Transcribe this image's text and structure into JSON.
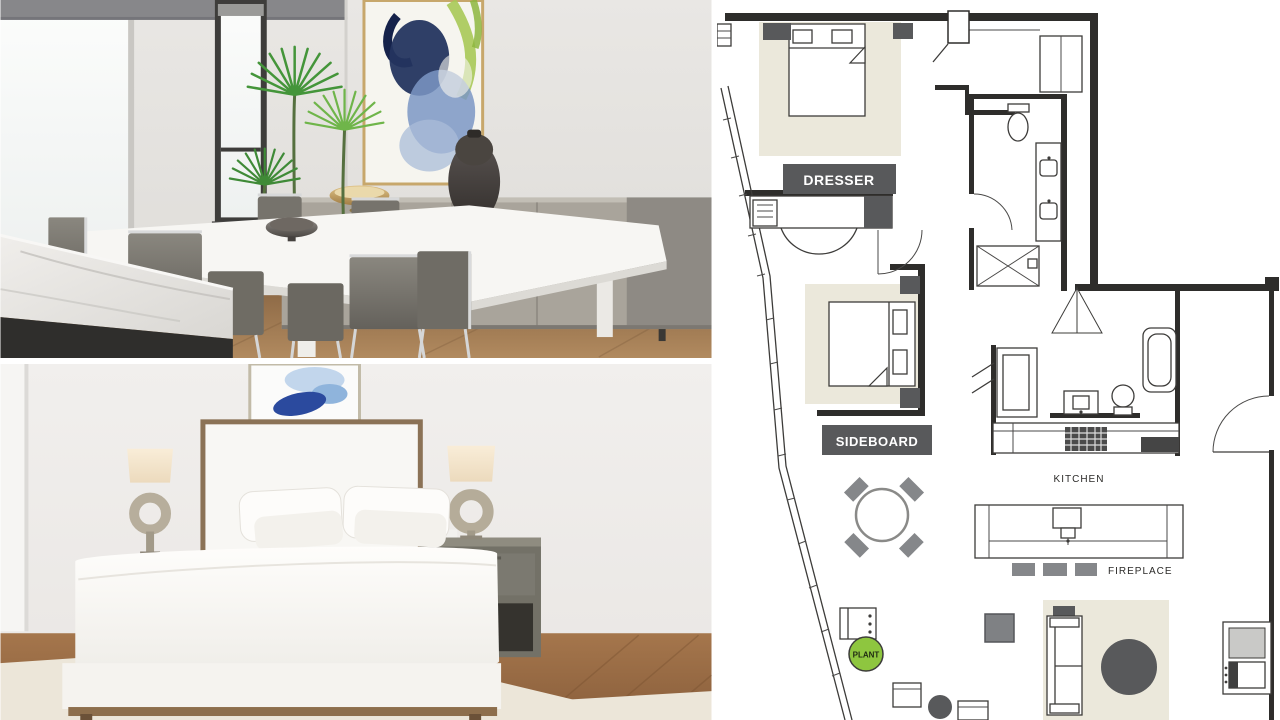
{
  "floorplan": {
    "labels": {
      "dresser": "DRESSER",
      "sideboard": "SIDEBOARD",
      "kitchen": "KITCHEN",
      "fireplace": "FIREPLACE",
      "plant": "PLANT"
    },
    "colors": {
      "wall": "#2e2d2b",
      "line": "#3d3c3a",
      "label_box_bg": "#58595b",
      "label_box_text": "#ffffff",
      "room_label_text": "#2b2a28",
      "rug": "#ebe8db",
      "furniture_dark": "#58595b",
      "furniture_mid": "#85878a",
      "plant_green": "#8ec63f",
      "plant_text": "#1f2a12"
    }
  }
}
